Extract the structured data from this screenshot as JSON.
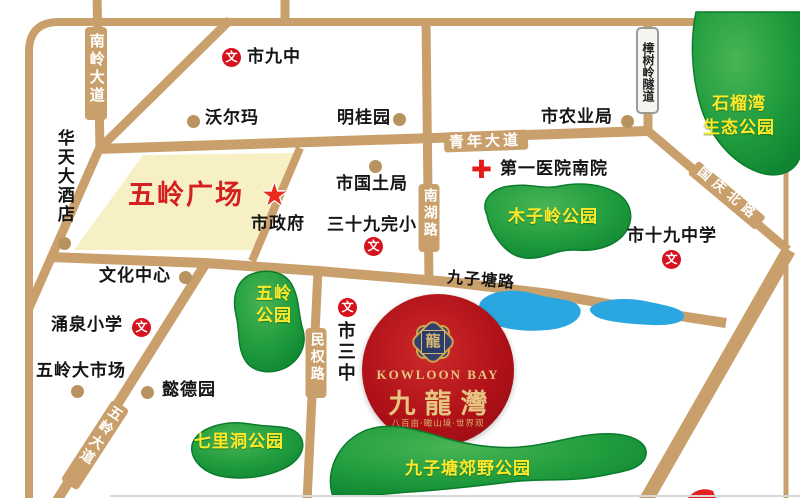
{
  "map": {
    "roads": {
      "nanling": "南岭大道",
      "qingnian": "青年大道",
      "nanhu": "南湖路",
      "zhangshuling": "樟树岭隧道",
      "guoqing": "国庆北路",
      "jiuzitang": "九子塘路",
      "minquan": "民权路",
      "wuling": "五岭大道"
    },
    "parks": {
      "shiliuwan_line1": "石榴湾",
      "shiliuwan_line2": "生态公园",
      "muziling": "木子岭公园",
      "wuling_line1": "五岭",
      "wuling_line2": "公园",
      "qilidong": "七里洞公园",
      "jiuzitang_country": "九子塘郊野公园"
    },
    "plaza": "五岭广场",
    "pois": {
      "shijiuzhong": "市九中",
      "walmart": "沃尔玛",
      "mingguiyuan": "明桂园",
      "shinongyeju": "市农业局",
      "diyiyiyuan": "第一医院南院",
      "shiguotuju": "市国土局",
      "sanshijiuwanxiao": "三十九完小",
      "shizhengfu": "市政府",
      "huatianhotel": "华天大酒店",
      "wenhuazhongxin": "文化中心",
      "yongquanxiaoxue": "涌泉小学",
      "wulingdashichang": "五岭大市场",
      "yideyuan": "懿德园",
      "shisanzhong": "市三中",
      "shishijiuzhongxue": "市十九中学"
    },
    "logo": {
      "seal_char": "龍",
      "en": "KOWLOON BAY",
      "cn": "九龍灣",
      "tagline": "八百亩·瞰山境·世界观"
    },
    "icons": {
      "school_badge": "文",
      "government_star": "★",
      "hospital_cross": "✚"
    },
    "colors": {
      "road": "#c9a06b",
      "park": "#1f9c3d",
      "water": "#2aa7e0",
      "plaza": "#f7f0c4",
      "logo_red": "#b01218",
      "gold": "#dcbd7e",
      "poi_dot": "#b8935f",
      "badge_red": "#d5121e",
      "park_label_yellow": "#ffe92a"
    }
  }
}
